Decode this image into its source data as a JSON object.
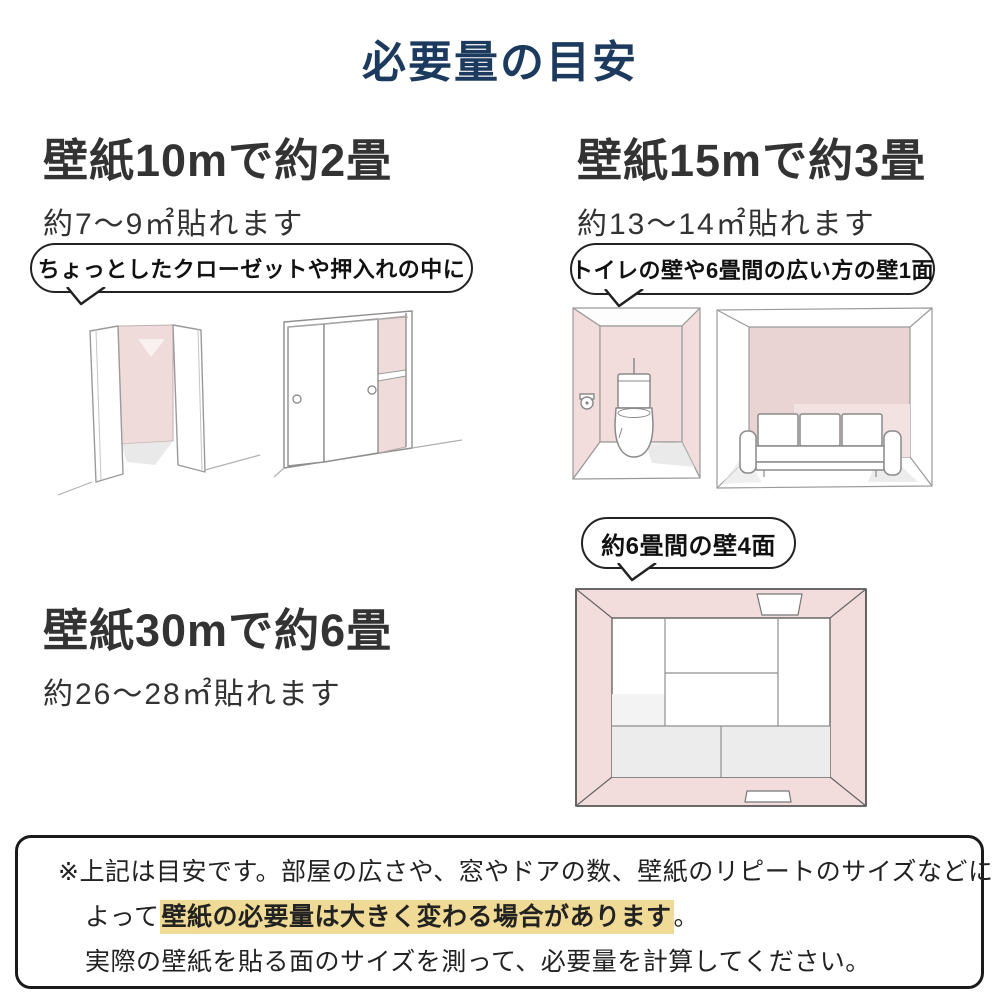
{
  "title": "必要量の目安",
  "sections": {
    "s10m": {
      "heading": "壁紙10mで約2畳",
      "subtext": "約7〜9㎡貼れます",
      "bubble": "ちょっとしたクローゼットや押入れの中に"
    },
    "s15m": {
      "heading": "壁紙15mで約3畳",
      "subtext": "約13〜14㎡貼れます",
      "bubble": "トイレの壁や6畳間の広い方の壁1面"
    },
    "s30m": {
      "heading": "壁紙30mで約6畳",
      "subtext": "約26〜28㎡貼れます",
      "bubble": "約6畳間の壁4面"
    }
  },
  "note": {
    "line1": "※上記は目安です。部屋の広さや、窓やドアの数、壁紙のリピートのサイズなどに",
    "line2_prefix": "よって",
    "line2_highlight": "壁紙の必要量は大きく変わる場合があります",
    "line2_suffix": "。",
    "line3": "実際の壁紙を貼る面のサイズを測って、必要量を計算してください。"
  },
  "colors": {
    "title_navy": "#1b3a5e",
    "text_dark": "#333333",
    "highlight_yellow": "#f0db96",
    "wall_pink": "#f2dcdc",
    "wall_pink_dark": "#e9d3d3",
    "outline_gray": "#8f8f8f",
    "note_border": "#1a1a1a"
  }
}
